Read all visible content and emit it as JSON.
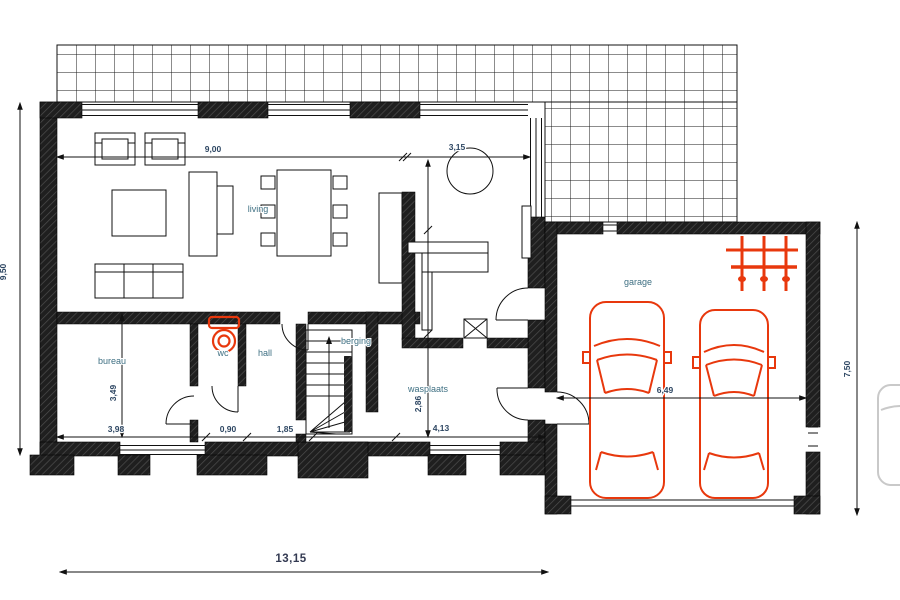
{
  "plan": {
    "rooms": {
      "living": "living",
      "bureau": "bureau",
      "wc": "wc",
      "hall": "hall",
      "berging": "berging",
      "wasplaats": "wasplaats",
      "garage": "garage"
    },
    "dimensions": {
      "living_width": "9,00",
      "nook_width": "3,15",
      "bureau_width": "3,98",
      "wc_width": "0,90",
      "hall_width": "1,85",
      "wasplaats_width": "4,13",
      "wasplaats_depth": "2,86",
      "bureau_depth": "3,49",
      "house_depth": "9,50",
      "total_width": "13,15",
      "garage_depth": "7,50",
      "garage_width": "6,49"
    },
    "colors": {
      "room_label": "#3f7083",
      "dimension_label": "#2e4763",
      "fixture_red": "#e8380d",
      "wall_dark": "#1f1f1f"
    }
  }
}
